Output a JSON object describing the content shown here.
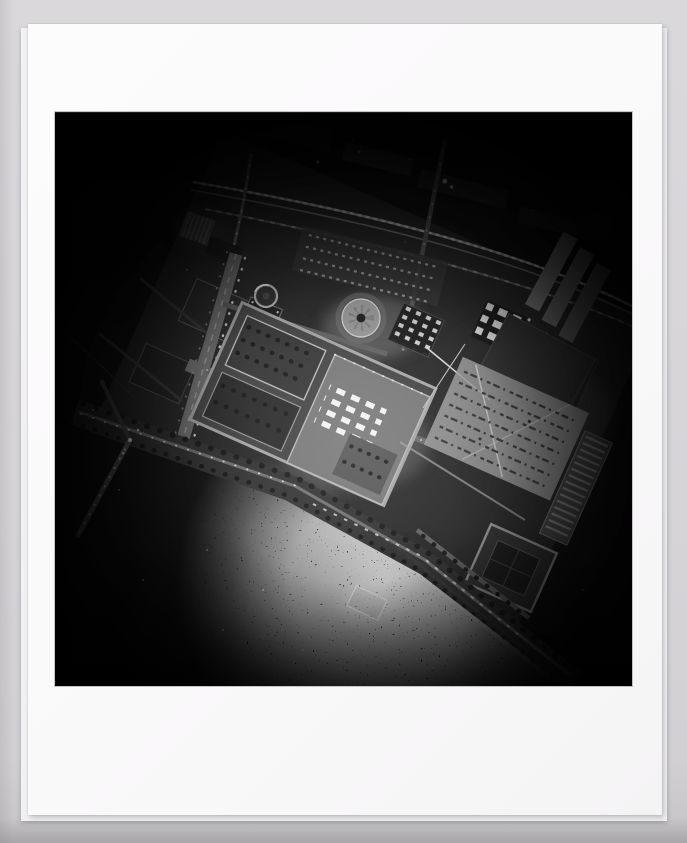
{
  "page": {
    "background_color": "#d6d4d7",
    "bottom_edge_color": "#a7a5a8"
  },
  "print": {
    "sheet_color": "#fbfafb",
    "backing_sheet_color": "#f1f0f2",
    "media_description": "Black-and-white photographic print on a white sheet over a slightly larger backing sheet"
  },
  "photograph": {
    "alt": "Vertical aerial photograph of an illuminated city quarter at night, street grid rotated diagonally, dark glittering river at lower left, frame corners falling off into blackness",
    "title": "Night aerial photograph",
    "palette": {
      "deep_black": "#050505",
      "city_ground": "#1c1c1c",
      "mid_gray": "#6f6f6f",
      "highlight": "#e8e8e8"
    },
    "features": [
      "railway-viaduct-upper-area",
      "rail-yard-sheds",
      "curving-ramp-road",
      "tram-boulevard",
      "palace-complex-with-courtyards",
      "small-rotunda",
      "large-dome-rotunda",
      "skylight-grid-roof",
      "lit-window-block",
      "parallel-exhibition-halls",
      "construction-field-with-material-rows",
      "formal-garden-parterre",
      "riverside-promenade-with-tree-rows",
      "bridge-crossroads",
      "moored-barge",
      "glittering-river-water",
      "corner-vignette"
    ]
  }
}
